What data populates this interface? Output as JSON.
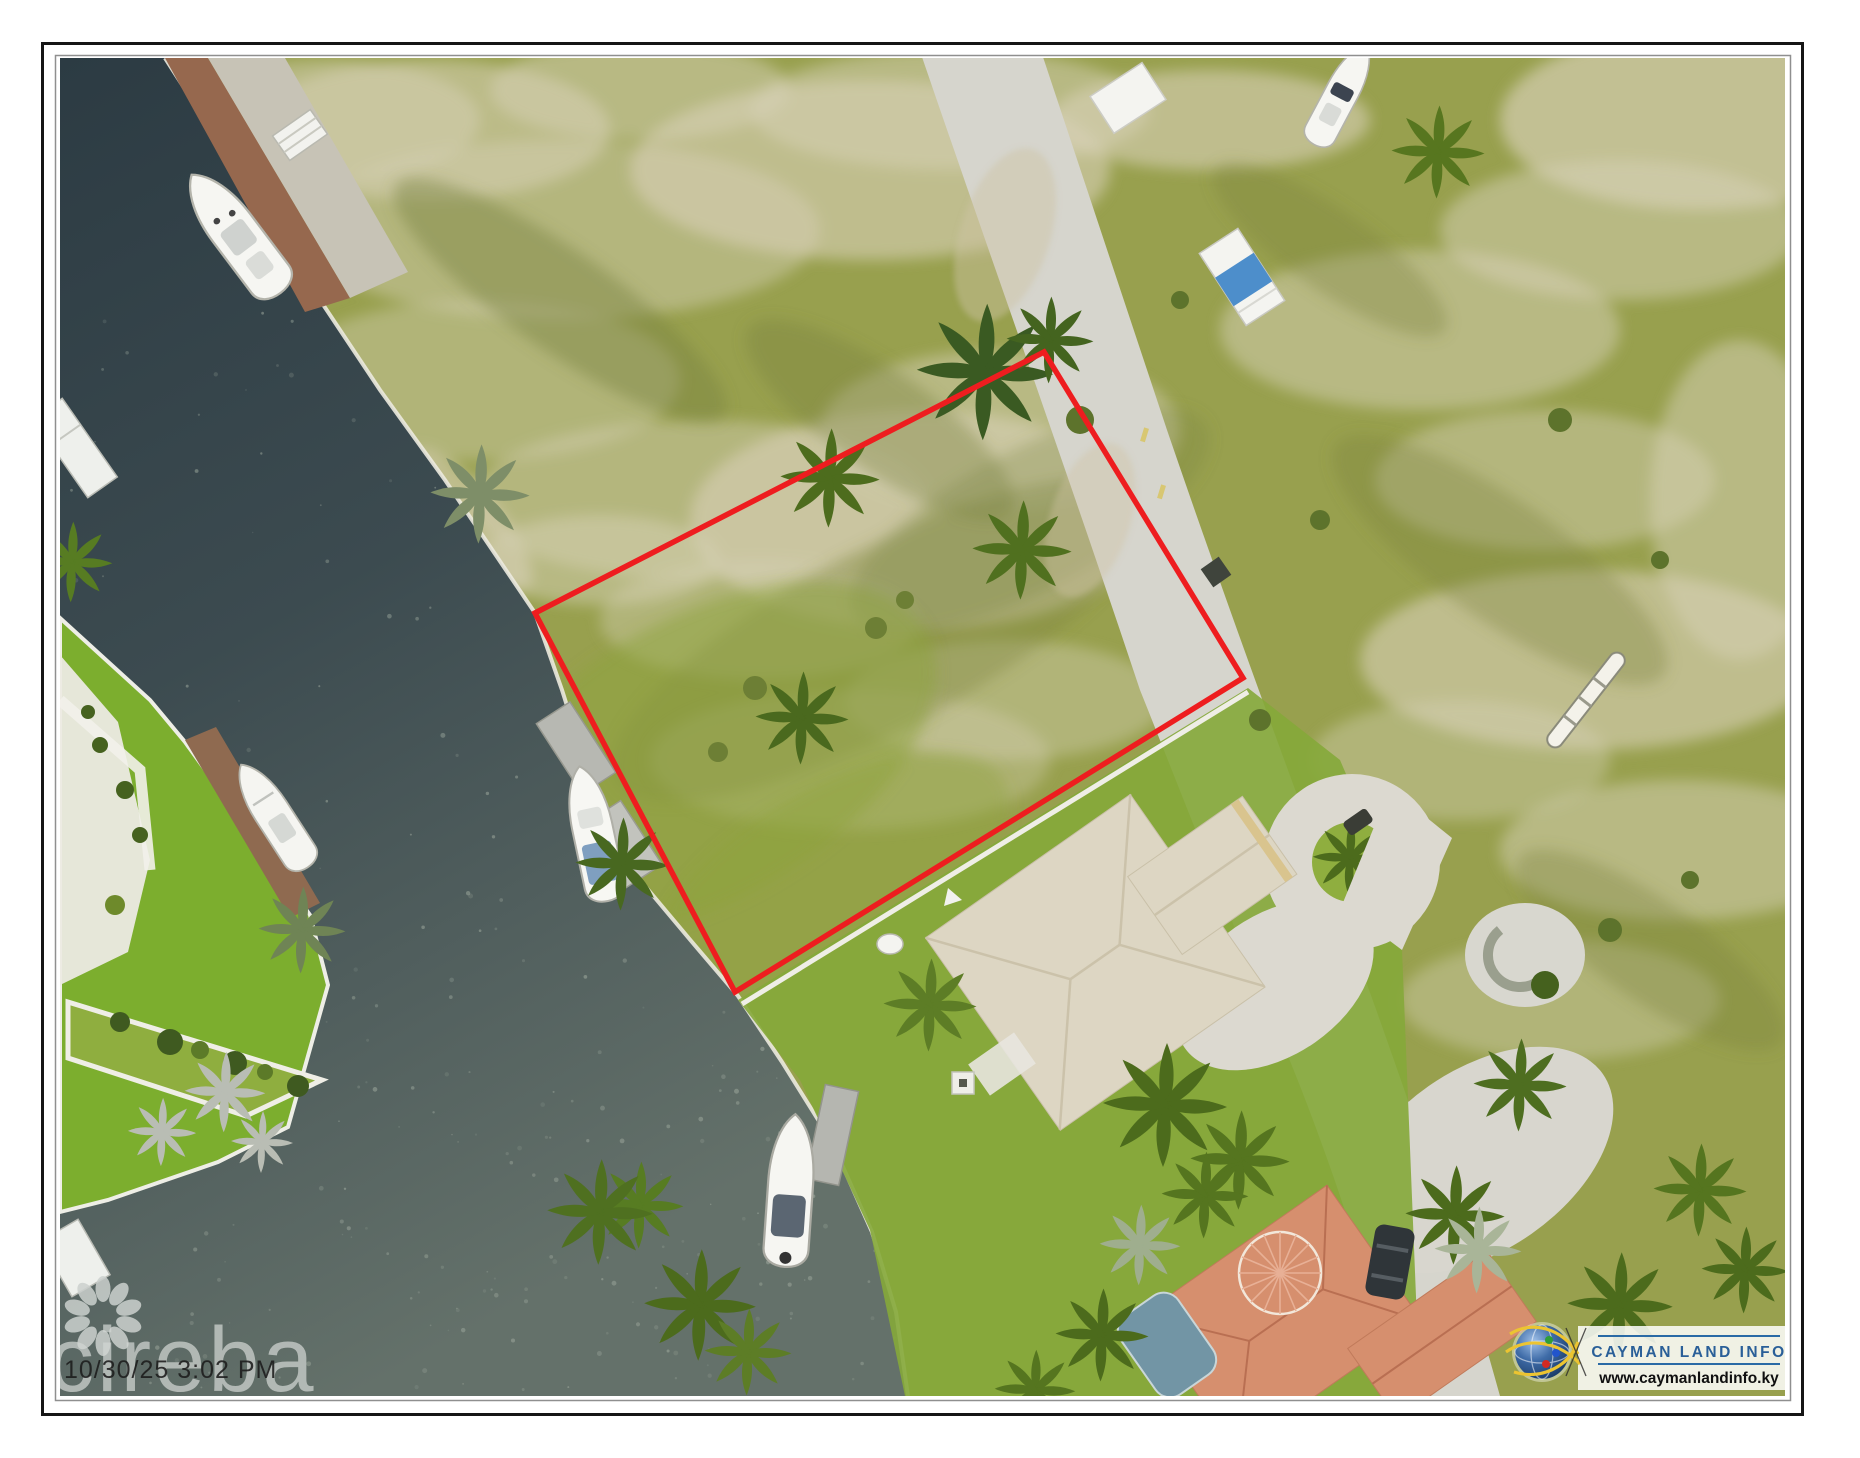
{
  "page": {
    "title": "Aerial parcel listing photo"
  },
  "frame": {
    "background": "#ffffff",
    "outer_border_color": "#161616",
    "inner_border_color": "#8f8f8f"
  },
  "watermarks": {
    "agency_logo_text": "cireba",
    "timestamp": "10/30/25 3:02 PM",
    "flower_icon_color": "#ccd1ce"
  },
  "provider": {
    "name": "CAYMAN LAND INFO",
    "url": "www.caymanlandinfo.ky",
    "name_color": "#2a5f98",
    "url_color": "#101010",
    "rule_color": "#2a6aa5",
    "globe_arc_color": "#ecc431"
  },
  "scene": {
    "type": "aerial-photo",
    "parcel_outline_color": "#ee1d1f",
    "parcel_outline_points": "535,613 1044,352 1243,678 735,992",
    "water_color_top": "#2c3b43",
    "water_color_bottom": "#64716a",
    "land_color": "#98a04e",
    "road_color": "#d6d5cd",
    "lawn_color": "#7cae2e",
    "dock_color": "#96684e",
    "roof_beige_color": "#ddd6c3",
    "roof_terracotta_color": "#d68f6e",
    "pool_color": "#7295a5"
  }
}
